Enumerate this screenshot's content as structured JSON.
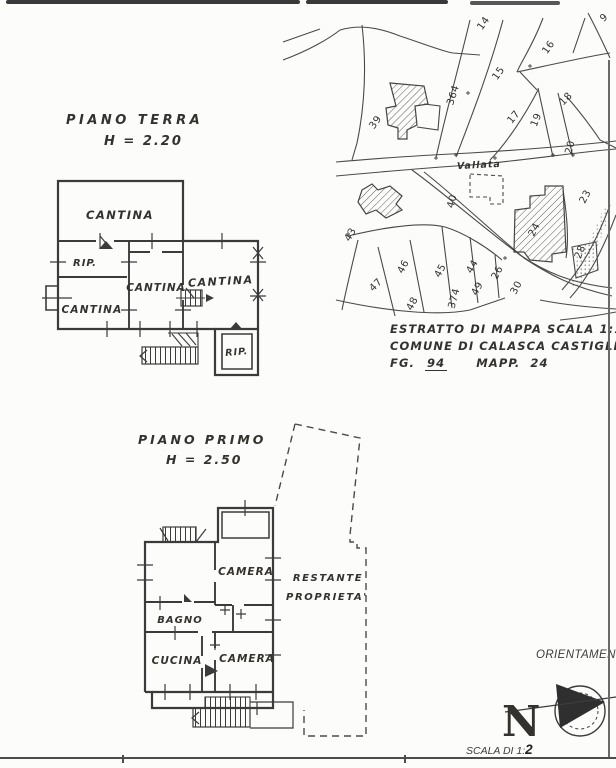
{
  "ground_floor": {
    "title": "PIANO TERRA",
    "height_label": "H = 2.20",
    "room_labels": {
      "cantina_top": "CANTINA",
      "rip_left": "RIP.",
      "cantina_left": "CANTINA",
      "cantina_mid": "CANTINA",
      "cantina_right": "CANTINA",
      "rip_bottom": "RIP."
    }
  },
  "first_floor": {
    "title": "PIANO PRIMO",
    "height_label": "H = 2.50",
    "room_labels": {
      "camera_top": "CAMERA",
      "bagno": "BAGNO",
      "cucina": "CUCINA",
      "camera_bottom": "CAMERA"
    },
    "remaining_property": {
      "line1": "RESTANTE",
      "line2": "PROPRIETA'"
    }
  },
  "map": {
    "road_label": "Vallata",
    "parcels": {
      "p9": "9",
      "p14": "14",
      "p15": "15",
      "p16": "16",
      "p17": "17",
      "p18": "18",
      "p19": "19",
      "p20": "20",
      "p23": "23",
      "p24": "24",
      "p26": "26",
      "p28": "28",
      "p30": "30",
      "p39": "39",
      "p40": "40",
      "p43": "43",
      "p44": "44",
      "p45": "45",
      "p46": "46",
      "p47": "47",
      "p48": "48",
      "p49": "49",
      "p364": "364",
      "p374": "374"
    },
    "caption": {
      "line1": "ESTRATTO DI MAPPA SCALA 1:10",
      "line2": "COMUNE DI CALASCA CASTIGLIO",
      "fg_label": "FG.",
      "fg_value": "94",
      "mapp_label": "MAPP.",
      "mapp_value": "24"
    }
  },
  "orientation": {
    "title": "ORIENTAMENT",
    "north_letter": "N",
    "scale_label": "SCALA DI 1:",
    "scale_value": "2"
  }
}
